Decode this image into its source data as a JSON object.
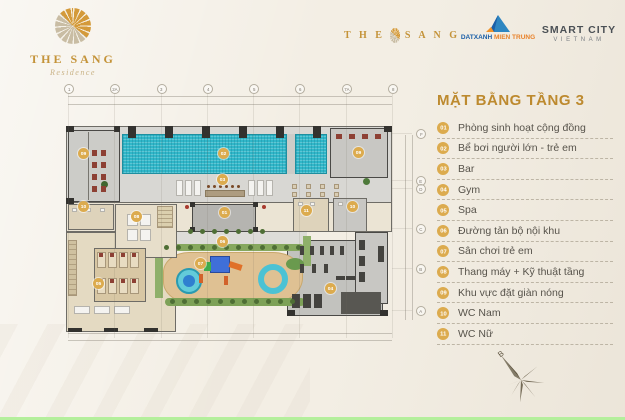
{
  "header": {
    "logo": {
      "title": "THE SANG",
      "subtitle": "Residence"
    },
    "partners": {
      "the_sang_inline": {
        "left": "T H E",
        "right": "S A N G"
      },
      "dat_xanh": {
        "name": "DATXANH",
        "region": "MIEN TRUNG"
      },
      "smart_city": {
        "line1": "SMART CITY",
        "line2": "VIETNAM"
      }
    }
  },
  "panel": {
    "title": "MẶT BẰNG TẦNG 3",
    "accent_color": "#bd8a2f",
    "legend": [
      {
        "num": "01",
        "label": "Phòng sinh hoạt cộng đồng"
      },
      {
        "num": "02",
        "label": "Bể bơi người lớn - trẻ em"
      },
      {
        "num": "03",
        "label": "Bar"
      },
      {
        "num": "04",
        "label": "Gym"
      },
      {
        "num": "05",
        "label": "Spa"
      },
      {
        "num": "06",
        "label": "Đường tản bộ nội khu"
      },
      {
        "num": "07",
        "label": "Sân chơi trẻ em"
      },
      {
        "num": "08",
        "label": "Thang máy + Kỹ thuật tầng"
      },
      {
        "num": "09",
        "label": "Khu vực đặt giàn nóng"
      },
      {
        "num": "10",
        "label": "WC Nam"
      },
      {
        "num": "11",
        "label": "WC Nữ"
      }
    ]
  },
  "plan": {
    "badge_color": "#dcab4e",
    "pool_color": "#30b7c9",
    "grid_top": [
      "1",
      "2A",
      "3",
      "4",
      "5",
      "6",
      "7A",
      "8"
    ],
    "grid_right": [
      "F",
      "E",
      "D",
      "C",
      "B",
      "A"
    ],
    "badges": [
      {
        "num": "09",
        "x": 83,
        "y": 153
      },
      {
        "num": "02",
        "x": 223,
        "y": 153
      },
      {
        "num": "09",
        "x": 358,
        "y": 152
      },
      {
        "num": "03",
        "x": 222,
        "y": 179
      },
      {
        "num": "10",
        "x": 83,
        "y": 206
      },
      {
        "num": "08",
        "x": 136,
        "y": 216
      },
      {
        "num": "01",
        "x": 224,
        "y": 212
      },
      {
        "num": "11",
        "x": 306,
        "y": 210
      },
      {
        "num": "10",
        "x": 352,
        "y": 206
      },
      {
        "num": "06",
        "x": 222,
        "y": 241
      },
      {
        "num": "07",
        "x": 200,
        "y": 263
      },
      {
        "num": "05",
        "x": 98,
        "y": 283
      },
      {
        "num": "04",
        "x": 330,
        "y": 288
      }
    ]
  },
  "compass": {
    "north_label": "B"
  }
}
